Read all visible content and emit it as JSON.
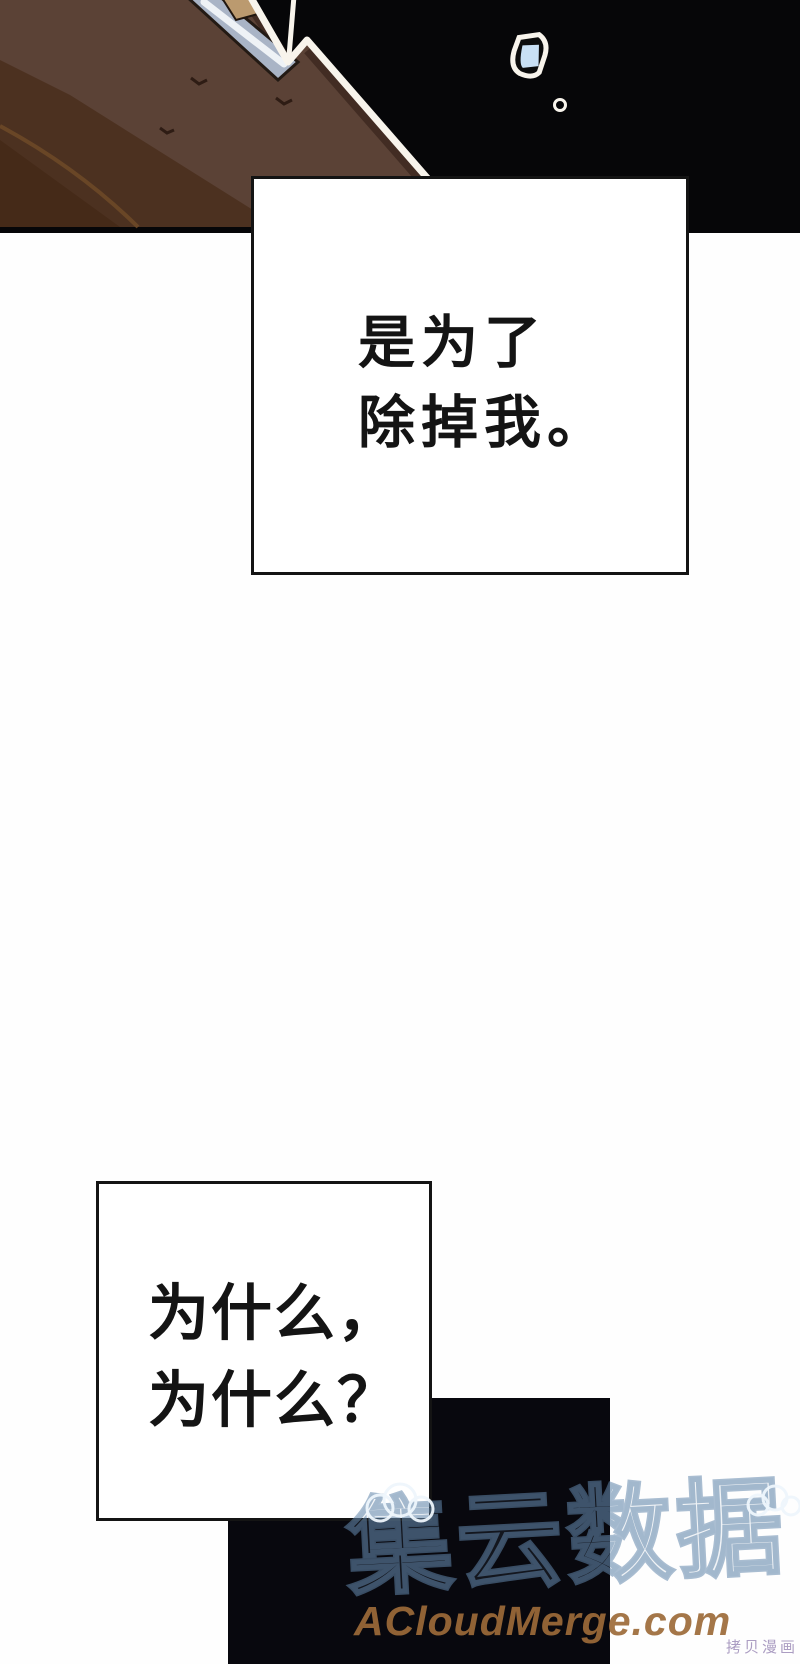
{
  "speech1": {
    "line1": "是为了",
    "line2": "除掉我。"
  },
  "speech2": {
    "line1": "为什么，",
    "line2": "为什么？"
  },
  "watermark": {
    "brand_cjk": "集云数据",
    "brand_site": "ACloudMerge.com",
    "copy_note": "拷贝漫画"
  },
  "colors": {
    "page_bg": "#fefefe",
    "panel_bg": "#060608",
    "box_bg": "#ffffff",
    "ink": "#141414",
    "black_rect": "#08080e",
    "slope_main": "#5b4236",
    "slope_shade": "#4c3120",
    "slope_corner": "#452a18",
    "slope_streak": "#6f4a28",
    "slope_edge": "#2e1c14",
    "outline": "#f8f4ec",
    "strip": "#a9b4c6",
    "strip_highlight": "#eef2f6",
    "tan": "#bb9a6f",
    "gem_fill": "#c9e0f4",
    "wm_blue": "rgba(98,134,172,0.55)",
    "wm_cloud": "rgba(238,245,252,0.95)",
    "wm_orange": "rgba(156,106,56,0.92)",
    "wm_small": "rgba(167,152,191,0.95)"
  }
}
